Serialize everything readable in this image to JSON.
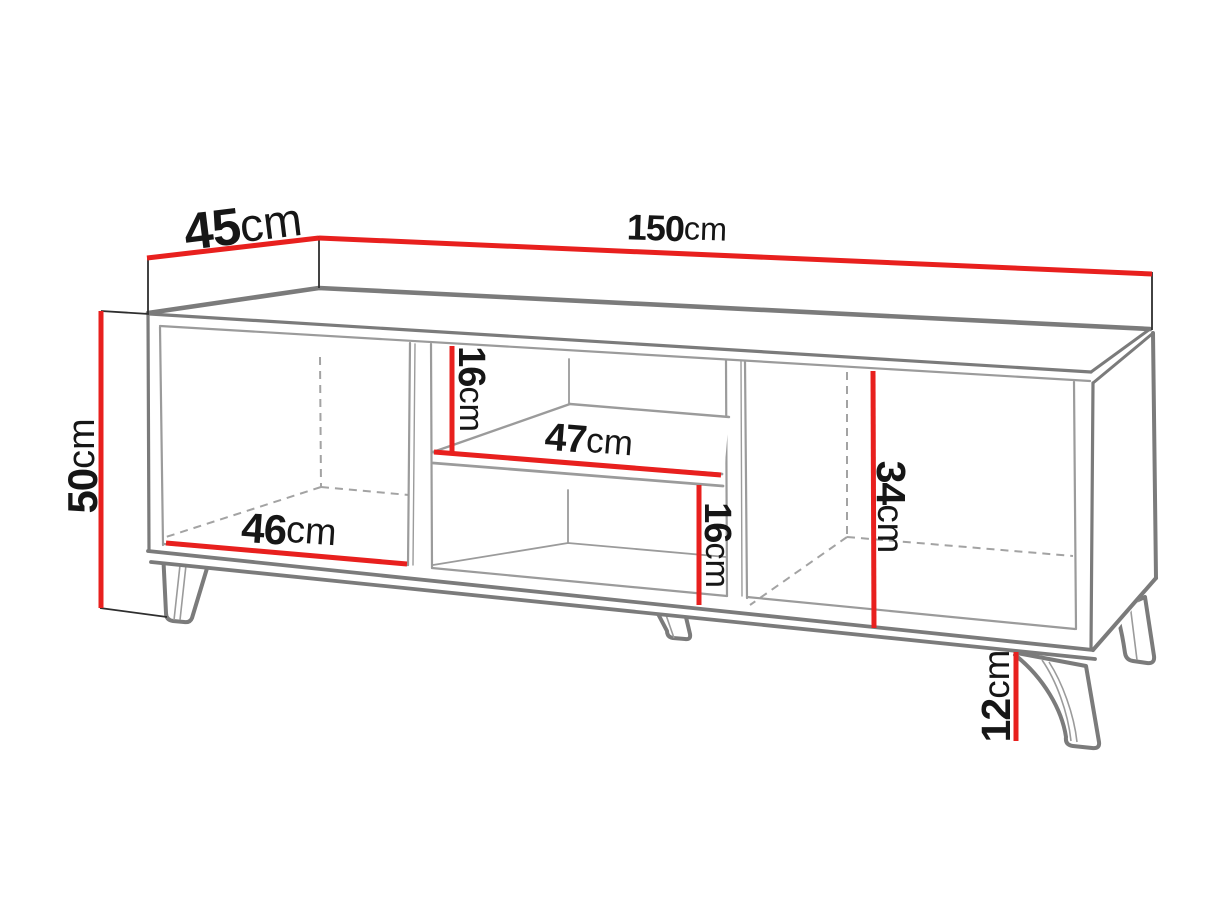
{
  "diagram": {
    "kind": "furniture-dimension-diagram",
    "subject": "TV stand with two dividers, middle shelf and four splayed legs"
  },
  "colors": {
    "dimension_line": "#e8201e",
    "outline_thick": "#7b7b7b",
    "outline_thin": "#9b9b9b",
    "hidden_edge": "#a3a3a3",
    "extension_line": "#2e2e2e",
    "label_text": "#161616",
    "background": "#ffffff"
  },
  "labels": {
    "depth": {
      "value": "45",
      "unit": "cm"
    },
    "width": {
      "value": "150",
      "unit": "cm"
    },
    "height": {
      "value": "50",
      "unit": "cm"
    },
    "left_compartment_width": {
      "value": "46",
      "unit": "cm"
    },
    "middle_shelf_width": {
      "value": "47",
      "unit": "cm"
    },
    "upper_niche_height": {
      "value": "16",
      "unit": "cm"
    },
    "lower_niche_height": {
      "value": "16",
      "unit": "cm"
    },
    "right_compartment_height": {
      "value": "34",
      "unit": "cm"
    },
    "leg_height": {
      "value": "12",
      "unit": "cm"
    }
  }
}
